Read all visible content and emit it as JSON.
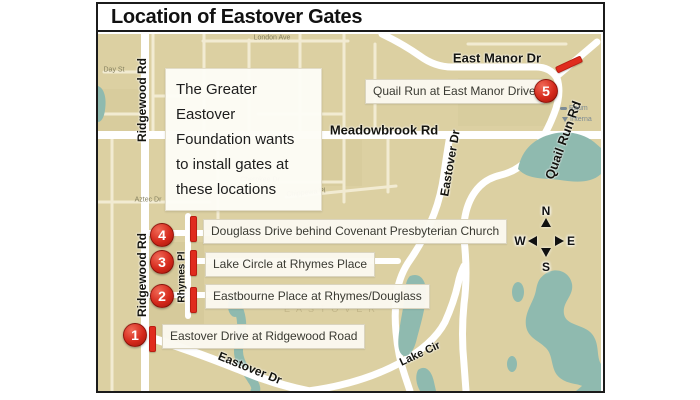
{
  "title": "Location of Eastover Gates",
  "info_box": {
    "text": "The Greater Eastover Foundation wants to install gates at these locations"
  },
  "gates": [
    {
      "num": "1",
      "label": "Eastover Drive at Ridgewood Road"
    },
    {
      "num": "2",
      "label": "Eastbourne Place at Rhymes/Douglass"
    },
    {
      "num": "3",
      "label": "Lake Circle at Rhymes Place"
    },
    {
      "num": "4",
      "label": "Douglass Drive behind Covenant Presbyterian Church"
    },
    {
      "num": "5",
      "label": "Quail Run at East Manor Drive"
    }
  ],
  "road_labels": {
    "ridgewood_n": "Ridgewood Rd",
    "ridgewood_s": "Ridgewood Rd",
    "meadowbrook": "Meadowbrook Rd",
    "east_manor": "East Manor Dr",
    "quail_run": "Quail Run Rd",
    "eastover_n": "Eastover Dr",
    "eastover_s": "Eastover Dr",
    "lake_cir": "Lake Cir",
    "rhymes": "Rhymes Pl"
  },
  "minor_labels": {
    "day": "Day St",
    "london": "London Ave",
    "cherokee": "Cherokee Dr",
    "chippewa": "Chippewa Pl",
    "aztec": "Aztec Dr"
  },
  "neighborhood": "EASTOVER",
  "compass": {
    "n": "N",
    "s": "S",
    "e": "E",
    "w": "W"
  },
  "edge_pois": {
    "poi1": "Raum",
    "poi2": "Interna"
  },
  "colors": {
    "map_bg": "#dcd0a2",
    "water": "#8fbaaf",
    "road": "#ffffff",
    "gate_red": "#d5291c",
    "box_bg": "#fbf9f0"
  }
}
